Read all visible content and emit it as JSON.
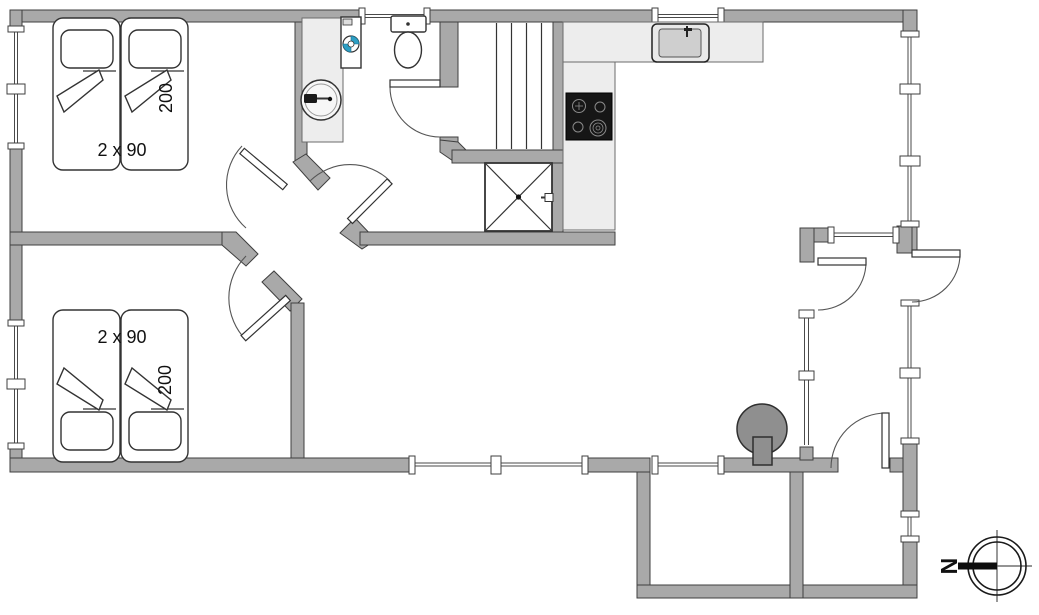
{
  "plan": {
    "type": "floor-plan",
    "bedroom1": {
      "bed_width": "2 x 90",
      "bed_length": "200"
    },
    "bedroom2": {
      "bed_width": "2 x 90",
      "bed_length": "200"
    },
    "compass": {
      "north": "N"
    },
    "colors": {
      "wall": "#a9a9a9",
      "wall_stroke": "#3f3f3f",
      "counter": "#ededed",
      "cooktop": "#161616",
      "wood_stove": "#8f8f8f",
      "washer_door_accent": "#2d9fc4",
      "line": "#333333",
      "background": "#ffffff"
    },
    "icons": {
      "beds": "twin-bed-icon",
      "washing_machine": "washing-machine-icon",
      "wash_basin": "wash-basin-icon",
      "toilet": "toilet-icon",
      "sauna_bench": "sauna-bench-icon",
      "shower": "shower-cabin-icon",
      "kitchen_sink": "kitchen-sink-icon",
      "cooktop": "cooktop-icon",
      "wood_stove": "wood-stove-icon",
      "compass": "compass-rose-icon",
      "doors": "door-swing-icon",
      "windows": "window-icon"
    }
  }
}
